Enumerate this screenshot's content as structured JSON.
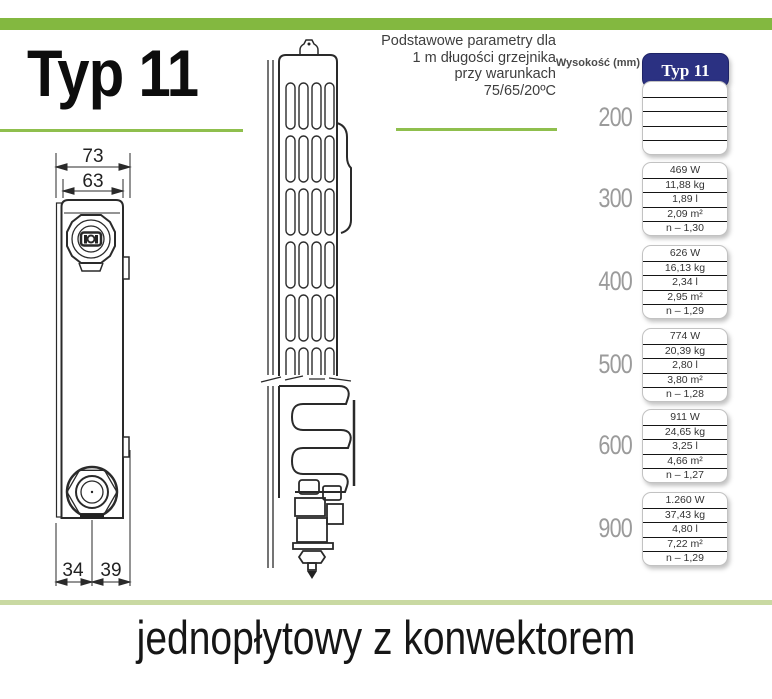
{
  "header": {
    "title": "Typ 11",
    "params_note_lines": [
      "Podstawowe parametry dla",
      "1 m długości grzejnika",
      "przy warunkach",
      "75/65/20ºC"
    ]
  },
  "table": {
    "height_column_label": "Wysokość (mm)",
    "type_column_header": "Typ 11",
    "rows": [
      {
        "height": "200",
        "values": [
          "",
          "",
          "",
          "",
          ""
        ]
      },
      {
        "height": "300",
        "values": [
          "469 W",
          "11,88 kg",
          "1,89 l",
          "2,09 m²",
          "n – 1,30"
        ]
      },
      {
        "height": "400",
        "values": [
          "626 W",
          "16,13 kg",
          "2,34 l",
          "2,95 m²",
          "n – 1,29"
        ]
      },
      {
        "height": "500",
        "values": [
          "774 W",
          "20,39 kg",
          "2,80 l",
          "3,80 m²",
          "n – 1,28"
        ]
      },
      {
        "height": "600",
        "values": [
          "911 W",
          "24,65 kg",
          "3,25 l",
          "4,66 m²",
          "n – 1,27"
        ]
      },
      {
        "height": "900",
        "values": [
          "1.260 W",
          "37,43 kg",
          "4,80 l",
          "7,22 m²",
          "n – 1,29"
        ]
      }
    ]
  },
  "drawings": {
    "front_view": {
      "dim_total_depth": "73",
      "dim_panel_depth": "63",
      "dim_bottom_left": "34",
      "dim_bottom_right": "39"
    }
  },
  "footer": {
    "caption": "jednopłytowy z konwektorem"
  },
  "colors": {
    "green_bar": "#83b840",
    "green_underline": "#8fbf4d",
    "pale_green_line": "#c9d9a2",
    "navy_header": "#2b3182",
    "height_label_gray": "#9b9b9b"
  }
}
